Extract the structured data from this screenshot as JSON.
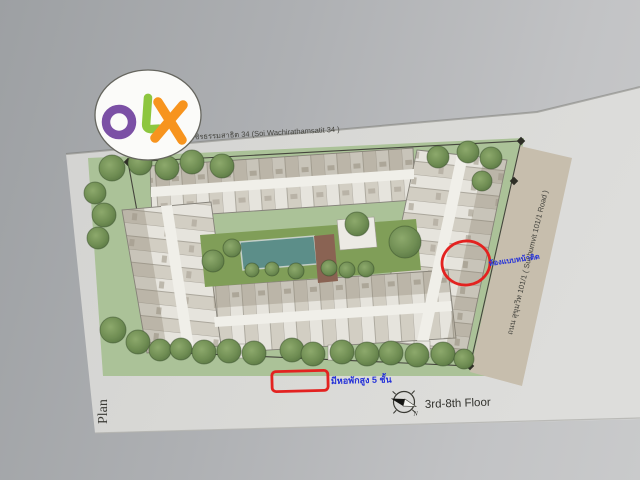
{
  "logo": {
    "text": "OLX",
    "letters": [
      {
        "char": "O",
        "color": "#7b50a5"
      },
      {
        "char": "L",
        "color": "#8dc63f"
      },
      {
        "char": "X",
        "color": "#f7941e"
      }
    ],
    "background": "#fbfbf9"
  },
  "labels": {
    "top_road": "ซอยวชิรธรรมสาธิต 34 (Soi Wachirathamsatit 34 )",
    "right_road": "ถนน สุขุมวิท 101/1 ( Sukhumvit 101/1 Road )",
    "plan": "Plan",
    "floor_range": "3rd-8th Floor",
    "compass_north": "N",
    "unit_note": "ห้องแบบหน้าติด",
    "dorm_note": "มีหอพักสูง 5 ชั้น"
  },
  "annotations": {
    "highlight_color": "#e32220",
    "note_color": "#2431d8",
    "circled_unit": {
      "cx": 466,
      "cy": 263,
      "rx": 24,
      "ry": 22
    },
    "boxed_area": {
      "x": 272,
      "y": 371,
      "w": 56,
      "h": 20
    }
  },
  "plan": {
    "site_color": "#abc298",
    "road_strip_color": "#c7bead",
    "building_light": "#e6e4dd",
    "building_dark": "#d2cec3",
    "pool_color": "#5c8e89",
    "lawn_color": "#809e58",
    "deck_color": "#8a6452",
    "boundary_color": "#44443c",
    "trees": [
      [
        112,
        168,
        13
      ],
      [
        140,
        163,
        12
      ],
      [
        167,
        168,
        12
      ],
      [
        192,
        162,
        12
      ],
      [
        222,
        166,
        12
      ],
      [
        95,
        193,
        11
      ],
      [
        104,
        215,
        12
      ],
      [
        98,
        238,
        11
      ],
      [
        113,
        330,
        13
      ],
      [
        138,
        342,
        12
      ],
      [
        160,
        350,
        11
      ],
      [
        181,
        349,
        11
      ],
      [
        204,
        352,
        12
      ],
      [
        229,
        351,
        12
      ],
      [
        254,
        353,
        12
      ],
      [
        292,
        350,
        12
      ],
      [
        313,
        354,
        12
      ],
      [
        342,
        352,
        12
      ],
      [
        367,
        354,
        12
      ],
      [
        391,
        353,
        12
      ],
      [
        417,
        355,
        12
      ],
      [
        443,
        354,
        12
      ],
      [
        464,
        359,
        10
      ],
      [
        438,
        157,
        11
      ],
      [
        468,
        152,
        11
      ],
      [
        491,
        158,
        11
      ],
      [
        482,
        181,
        10
      ],
      [
        405,
        242,
        16
      ],
      [
        357,
        224,
        12
      ],
      [
        329,
        268,
        8
      ],
      [
        347,
        270,
        8
      ],
      [
        366,
        269,
        8
      ],
      [
        213,
        261,
        11
      ],
      [
        232,
        248,
        9
      ],
      [
        252,
        270,
        7
      ],
      [
        272,
        269,
        7
      ],
      [
        296,
        271,
        8
      ]
    ]
  }
}
